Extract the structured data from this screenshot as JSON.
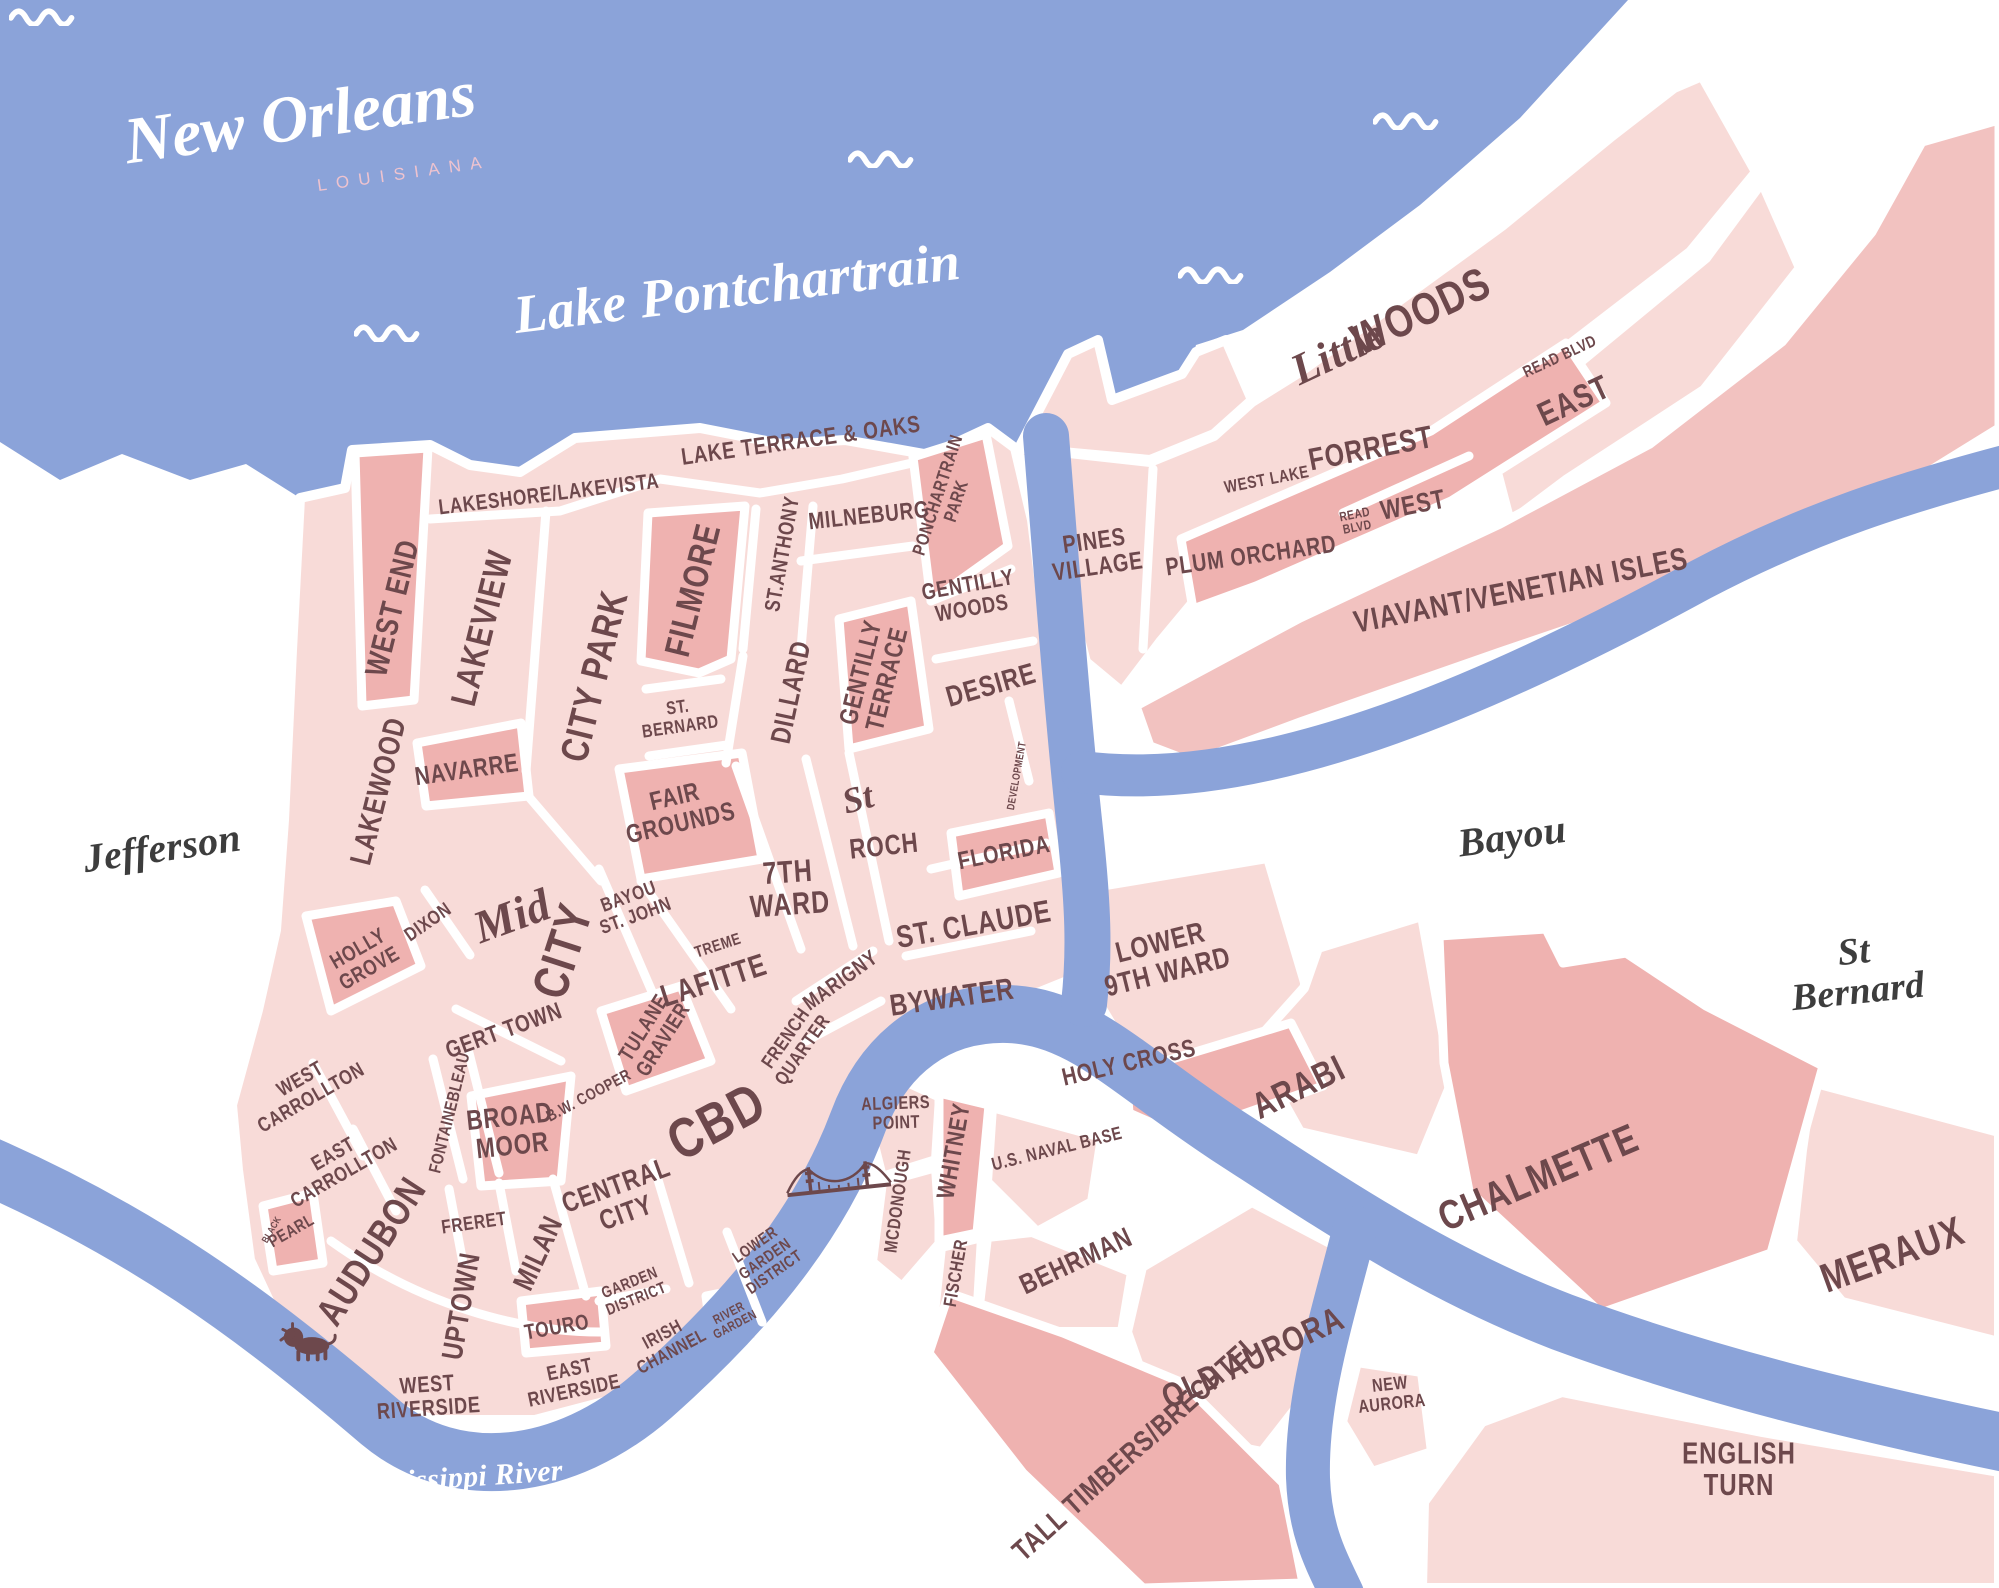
{
  "title": {
    "name": "New Orleans",
    "state": "LOUISIANA"
  },
  "colors": {
    "water": "#8ba3d9",
    "land_light": "#f8dbd8",
    "land_mid": "#f2c2c0",
    "land_dark": "#efb2b0",
    "label_maroon": "#6d484c",
    "script_ink": "#3d3d3d",
    "subtitle_rose": "#eec3cf",
    "water_label": "#ffffff"
  },
  "labels": [
    {
      "id": "lake-pontchartrain",
      "t": "Lake Pontchartrain",
      "x": 737,
      "y": 288,
      "r": -7,
      "s": 54,
      "st": "script",
      "c": "white"
    },
    {
      "id": "mississippi-river",
      "t": "Mississippi River",
      "x": 455,
      "y": 1478,
      "r": -4,
      "s": 30,
      "st": "script",
      "c": "white"
    },
    {
      "id": "jefferson",
      "t": "Jefferson",
      "x": 162,
      "y": 848,
      "r": -8,
      "s": 40,
      "st": "script",
      "c": "ink"
    },
    {
      "id": "bayou",
      "t": "Bayou",
      "x": 1512,
      "y": 836,
      "r": -8,
      "s": 40,
      "st": "script",
      "c": "ink"
    },
    {
      "id": "st-bernard-parish",
      "t": "St Bernard",
      "x": 1856,
      "y": 972,
      "r": -6,
      "s": 38,
      "st": "script",
      "c": "ink"
    },
    {
      "id": "west-end",
      "t": "WEST END",
      "x": 393,
      "y": 608,
      "r": -76,
      "s": 29
    },
    {
      "id": "lakeshore-lakevista",
      "t": "LAKESHORE/LAKEVISTA",
      "x": 549,
      "y": 495,
      "r": -7,
      "s": 20
    },
    {
      "id": "lakeview",
      "t": "LAKEVIEW",
      "x": 482,
      "y": 628,
      "r": -76,
      "s": 33
    },
    {
      "id": "city-park",
      "t": "CITY PARK",
      "x": 594,
      "y": 676,
      "r": -76,
      "s": 36
    },
    {
      "id": "filmore",
      "t": "FILMORE",
      "x": 693,
      "y": 590,
      "r": -76,
      "s": 33
    },
    {
      "id": "st-bernard-nbhd",
      "t": "ST.\nBERNARD",
      "x": 679,
      "y": 717,
      "r": -8,
      "s": 17
    },
    {
      "id": "lake-terrace-oaks",
      "t": "LAKE TERRACE & OAKS",
      "x": 801,
      "y": 441,
      "r": -8,
      "s": 22
    },
    {
      "id": "st-anthony",
      "t": "ST.ANTHONY",
      "x": 783,
      "y": 554,
      "r": -80,
      "s": 20
    },
    {
      "id": "milneburg",
      "t": "MILNEBURG",
      "x": 869,
      "y": 516,
      "r": -6,
      "s": 22
    },
    {
      "id": "ponchartrain-park",
      "t": "PONCHARTRAIN\nPARK",
      "x": 947,
      "y": 498,
      "r": -72,
      "s": 17
    },
    {
      "id": "gentilly-woods",
      "t": "GENTILLY\nWOODS",
      "x": 970,
      "y": 597,
      "r": -10,
      "s": 21
    },
    {
      "id": "dillard",
      "t": "DILLARD",
      "x": 791,
      "y": 692,
      "r": -78,
      "s": 26
    },
    {
      "id": "gentilly-terrace",
      "t": "GENTILLY\nTERRACE",
      "x": 875,
      "y": 676,
      "r": -76,
      "s": 24
    },
    {
      "id": "desire",
      "t": "DESIRE",
      "x": 991,
      "y": 685,
      "r": -16,
      "s": 27
    },
    {
      "id": "development",
      "t": "DEVELOPMENT",
      "x": 1018,
      "y": 776,
      "r": -80,
      "s": 10
    },
    {
      "id": "florida",
      "t": "FLORIDA",
      "x": 1004,
      "y": 853,
      "r": -11,
      "s": 23
    },
    {
      "id": "fair-grounds",
      "t": "FAIR\nGROUNDS",
      "x": 678,
      "y": 811,
      "r": -13,
      "s": 24
    },
    {
      "id": "seventh-ward",
      "t": "7TH\nWARD",
      "x": 789,
      "y": 889,
      "r": -4,
      "s": 29
    },
    {
      "id": "st-roch-script",
      "t": "St",
      "x": 858,
      "y": 799,
      "r": -15,
      "s": 36,
      "st": "script"
    },
    {
      "id": "st-roch",
      "t": "ROCH",
      "x": 884,
      "y": 846,
      "r": -6,
      "s": 26
    },
    {
      "id": "st-claude",
      "t": "ST. CLAUDE",
      "x": 974,
      "y": 925,
      "r": -10,
      "s": 29
    },
    {
      "id": "bywater",
      "t": "BYWATER",
      "x": 952,
      "y": 997,
      "r": -8,
      "s": 28
    },
    {
      "id": "navarre",
      "t": "NAVARRE",
      "x": 467,
      "y": 771,
      "r": -8,
      "s": 24
    },
    {
      "id": "lakewood",
      "t": "LAKEWOOD",
      "x": 378,
      "y": 791,
      "r": -76,
      "s": 28
    },
    {
      "id": "dixon",
      "t": "DIXON",
      "x": 428,
      "y": 922,
      "r": -35,
      "s": 18
    },
    {
      "id": "holly-grove",
      "t": "HOLLY\nGROVE",
      "x": 364,
      "y": 959,
      "r": -30,
      "s": 20
    },
    {
      "id": "mid-city-script",
      "t": "Mid",
      "x": 512,
      "y": 916,
      "r": -20,
      "s": 46,
      "st": "script"
    },
    {
      "id": "mid-city",
      "t": "CITY",
      "x": 563,
      "y": 951,
      "r": -72,
      "s": 46
    },
    {
      "id": "bayou-st-john",
      "t": "BAYOU\nST. JOHN",
      "x": 632,
      "y": 906,
      "r": -20,
      "s": 18
    },
    {
      "id": "gert-town",
      "t": "GERT TOWN",
      "x": 504,
      "y": 1031,
      "r": -20,
      "s": 22
    },
    {
      "id": "tulane-gravier",
      "t": "TULANE\nGRAVIER",
      "x": 654,
      "y": 1034,
      "r": -58,
      "s": 20
    },
    {
      "id": "treme",
      "t": "TREME",
      "x": 718,
      "y": 946,
      "r": -18,
      "s": 15
    },
    {
      "id": "lafitte",
      "t": "LAFITTE",
      "x": 714,
      "y": 981,
      "r": -18,
      "s": 29
    },
    {
      "id": "marigny",
      "t": "MARIGNY",
      "x": 841,
      "y": 981,
      "r": -36,
      "s": 20
    },
    {
      "id": "french-quarter",
      "t": "FRENCH\nQUARTER",
      "x": 794,
      "y": 1044,
      "r": -55,
      "s": 18
    },
    {
      "id": "cbd",
      "t": "CBD",
      "x": 717,
      "y": 1122,
      "r": -28,
      "s": 52
    },
    {
      "id": "bw-cooper",
      "t": "B.W. COOPER",
      "x": 589,
      "y": 1096,
      "r": -28,
      "s": 15
    },
    {
      "id": "broad-moor",
      "t": "BROAD\nMOOR",
      "x": 511,
      "y": 1131,
      "r": -6,
      "s": 26
    },
    {
      "id": "fontainebleau",
      "t": "FONTAINEBLEAU",
      "x": 451,
      "y": 1113,
      "r": -76,
      "s": 16
    },
    {
      "id": "west-carrollton",
      "t": "WEST\nCARROLLTON",
      "x": 306,
      "y": 1089,
      "r": -30,
      "s": 19
    },
    {
      "id": "east-carrollton",
      "t": "EAST\nCARROLLTON",
      "x": 339,
      "y": 1164,
      "r": -30,
      "s": 19
    },
    {
      "id": "black-pearl-black",
      "t": "BLACK",
      "x": 272,
      "y": 1230,
      "r": -60,
      "s": 9
    },
    {
      "id": "black-pearl",
      "t": "PEARL",
      "x": 292,
      "y": 1232,
      "r": -30,
      "s": 16
    },
    {
      "id": "audubon",
      "t": "AUDUBON",
      "x": 371,
      "y": 1251,
      "r": -57,
      "s": 36
    },
    {
      "id": "freret",
      "t": "FRERET",
      "x": 474,
      "y": 1223,
      "r": -8,
      "s": 18
    },
    {
      "id": "uptown",
      "t": "UPTOWN",
      "x": 461,
      "y": 1306,
      "r": -80,
      "s": 27
    },
    {
      "id": "milan",
      "t": "MILAN",
      "x": 538,
      "y": 1253,
      "r": -65,
      "s": 27
    },
    {
      "id": "central-city",
      "t": "CENTRAL\nCITY",
      "x": 621,
      "y": 1199,
      "r": -20,
      "s": 26
    },
    {
      "id": "garden-district",
      "t": "GARDEN\nDISTRICT",
      "x": 633,
      "y": 1291,
      "r": -22,
      "s": 15
    },
    {
      "id": "touro",
      "t": "TOURO",
      "x": 557,
      "y": 1328,
      "r": -10,
      "s": 20
    },
    {
      "id": "irish-channel",
      "t": "IRISH\nCHANNEL",
      "x": 667,
      "y": 1343,
      "r": -28,
      "s": 17
    },
    {
      "id": "river-garden",
      "t": "RIVER\nGARDEN",
      "x": 732,
      "y": 1319,
      "r": -28,
      "s": 12
    },
    {
      "id": "lower-garden-district",
      "t": "LOWER\nGARDEN\nDISTRICT",
      "x": 765,
      "y": 1259,
      "r": -35,
      "s": 15
    },
    {
      "id": "east-riverside",
      "t": "EAST\nRIVERSIDE",
      "x": 572,
      "y": 1381,
      "r": -12,
      "s": 19
    },
    {
      "id": "west-riverside",
      "t": "WEST\nRIVERSIDE",
      "x": 428,
      "y": 1397,
      "r": -4,
      "s": 21
    },
    {
      "id": "algiers-point",
      "t": "ALGIERS\nPOINT",
      "x": 896,
      "y": 1113,
      "r": -2,
      "s": 17
    },
    {
      "id": "whitney",
      "t": "WHITNEY",
      "x": 954,
      "y": 1151,
      "r": -80,
      "s": 23
    },
    {
      "id": "mcdonough",
      "t": "MCDONOUGH",
      "x": 898,
      "y": 1201,
      "r": -82,
      "s": 17
    },
    {
      "id": "fischer",
      "t": "FISCHER",
      "x": 956,
      "y": 1273,
      "r": -80,
      "s": 17
    },
    {
      "id": "us-naval-base",
      "t": "U.S. NAVAL BASE",
      "x": 1057,
      "y": 1149,
      "r": -14,
      "s": 17
    },
    {
      "id": "behrman",
      "t": "BEHRMAN",
      "x": 1076,
      "y": 1261,
      "r": -25,
      "s": 26
    },
    {
      "id": "old-aurora",
      "t": "OLD AURORA",
      "x": 1253,
      "y": 1358,
      "r": -25,
      "s": 32
    },
    {
      "id": "new-aurora",
      "t": "NEW\nAURORA",
      "x": 1391,
      "y": 1394,
      "r": -6,
      "s": 17
    },
    {
      "id": "tall-timbers-brechtel",
      "t": "TALL TIMBERS/BRECHTEL",
      "x": 1136,
      "y": 1448,
      "r": -42,
      "s": 27
    },
    {
      "id": "lower-9th-ward",
      "t": "LOWER\n9TH WARD",
      "x": 1164,
      "y": 957,
      "r": -14,
      "s": 27
    },
    {
      "id": "holy-cross",
      "t": "HOLY CROSS",
      "x": 1129,
      "y": 1063,
      "r": -13,
      "s": 23
    },
    {
      "id": "arabi",
      "t": "ARABI",
      "x": 1299,
      "y": 1088,
      "r": -26,
      "s": 34
    },
    {
      "id": "chalmette",
      "t": "CHALMETTE",
      "x": 1539,
      "y": 1179,
      "r": -23,
      "s": 38
    },
    {
      "id": "meraux",
      "t": "MERAUX",
      "x": 1893,
      "y": 1256,
      "r": -20,
      "s": 38
    },
    {
      "id": "english-turn",
      "t": "ENGLISH\nTURN",
      "x": 1739,
      "y": 1469,
      "r": 0,
      "s": 28
    },
    {
      "id": "pines-village",
      "t": "PINES\nVILLAGE",
      "x": 1096,
      "y": 554,
      "r": -8,
      "s": 23
    },
    {
      "id": "plum-orchard",
      "t": "PLUM ORCHARD",
      "x": 1251,
      "y": 556,
      "r": -8,
      "s": 23
    },
    {
      "id": "west-lake",
      "t": "WEST LAKE",
      "x": 1267,
      "y": 481,
      "r": -11,
      "s": 16
    },
    {
      "id": "forrest",
      "t": "FORREST",
      "x": 1371,
      "y": 449,
      "r": -11,
      "s": 29
    },
    {
      "id": "read-blvd-small-w",
      "t": "READ\nBLVD",
      "x": 1356,
      "y": 521,
      "r": -11,
      "s": 12
    },
    {
      "id": "read-blvd-west",
      "t": "WEST",
      "x": 1413,
      "y": 505,
      "r": -11,
      "s": 25
    },
    {
      "id": "read-blvd-small-e",
      "t": "READ BLVD",
      "x": 1560,
      "y": 357,
      "r": -25,
      "s": 15
    },
    {
      "id": "read-blvd-east",
      "t": "EAST",
      "x": 1574,
      "y": 401,
      "r": -25,
      "s": 31
    },
    {
      "id": "little-script",
      "t": "Little",
      "x": 1338,
      "y": 352,
      "r": -25,
      "s": 44,
      "st": "script"
    },
    {
      "id": "little-woods",
      "t": "WOODS",
      "x": 1421,
      "y": 311,
      "r": -25,
      "s": 42
    },
    {
      "id": "viavant-venetian-isles",
      "t": "VIAVANT/VENETIAN ISLES",
      "x": 1521,
      "y": 591,
      "r": -11,
      "s": 29
    }
  ],
  "icons": {
    "waves": [
      {
        "x": 45,
        "y": 16
      },
      {
        "x": 390,
        "y": 332
      },
      {
        "x": 884,
        "y": 158
      },
      {
        "x": 1214,
        "y": 274
      },
      {
        "x": 1409,
        "y": 120
      }
    ],
    "bridge": {
      "x": 838,
      "y": 1178,
      "r": -6
    },
    "lion": {
      "x": 308,
      "y": 1342
    }
  }
}
